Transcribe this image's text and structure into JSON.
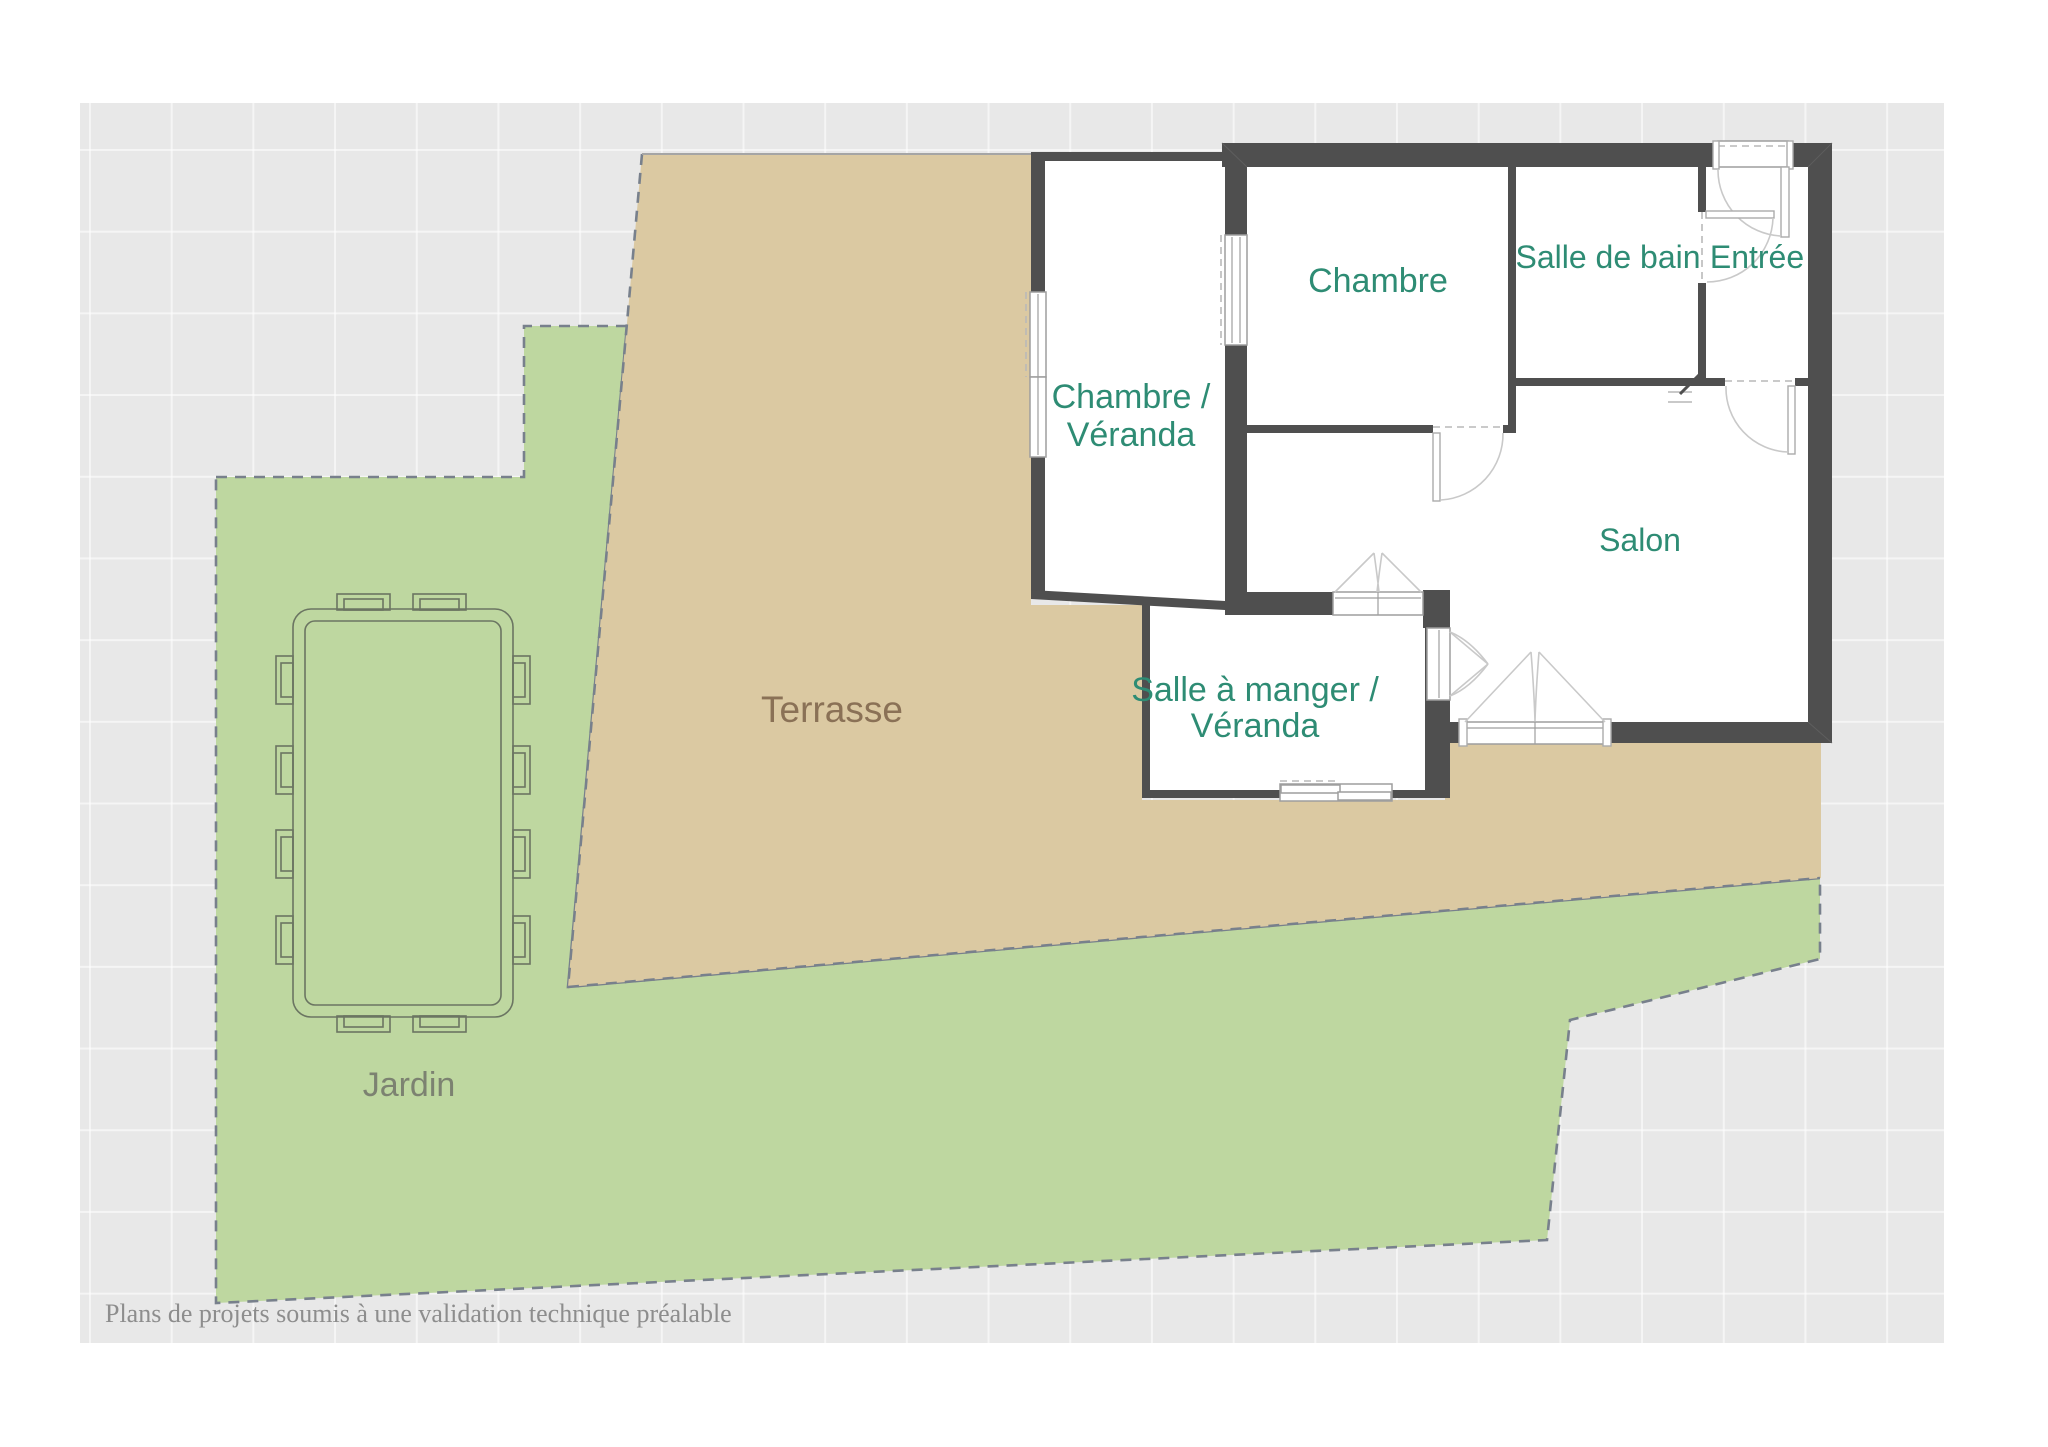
{
  "meta": {
    "type": "floor-plan",
    "footer_note": "Plans de projets soumis à une validation technique préalable"
  },
  "colors": {
    "wall": "#4f4f4f",
    "terrace_fill": "#dbc9a2",
    "garden_fill": "#bed7a0",
    "panel_background": "#e8e8e8",
    "room_label": "#2e8c74",
    "terrace_label": "#8a7156",
    "garden_label": "#7c8271",
    "boundary_dash": "#78808c",
    "footer_text": "#8d8d8d"
  },
  "rooms": {
    "chambre_veranda": {
      "line1": "Chambre /",
      "line2": "Véranda"
    },
    "chambre": {
      "label": "Chambre"
    },
    "salle_de_bain": {
      "label": "Salle de bain"
    },
    "entree": {
      "label": "Entrée"
    },
    "salon": {
      "label": "Salon"
    },
    "salle_a_manger_veranda": {
      "line1": "Salle à manger /",
      "line2": "Véranda"
    }
  },
  "outdoor": {
    "terrasse": {
      "label": "Terrasse"
    },
    "jardin": {
      "label": "Jardin"
    }
  },
  "footer": {
    "text": "Plans de projets soumis à une validation technique préalable"
  }
}
